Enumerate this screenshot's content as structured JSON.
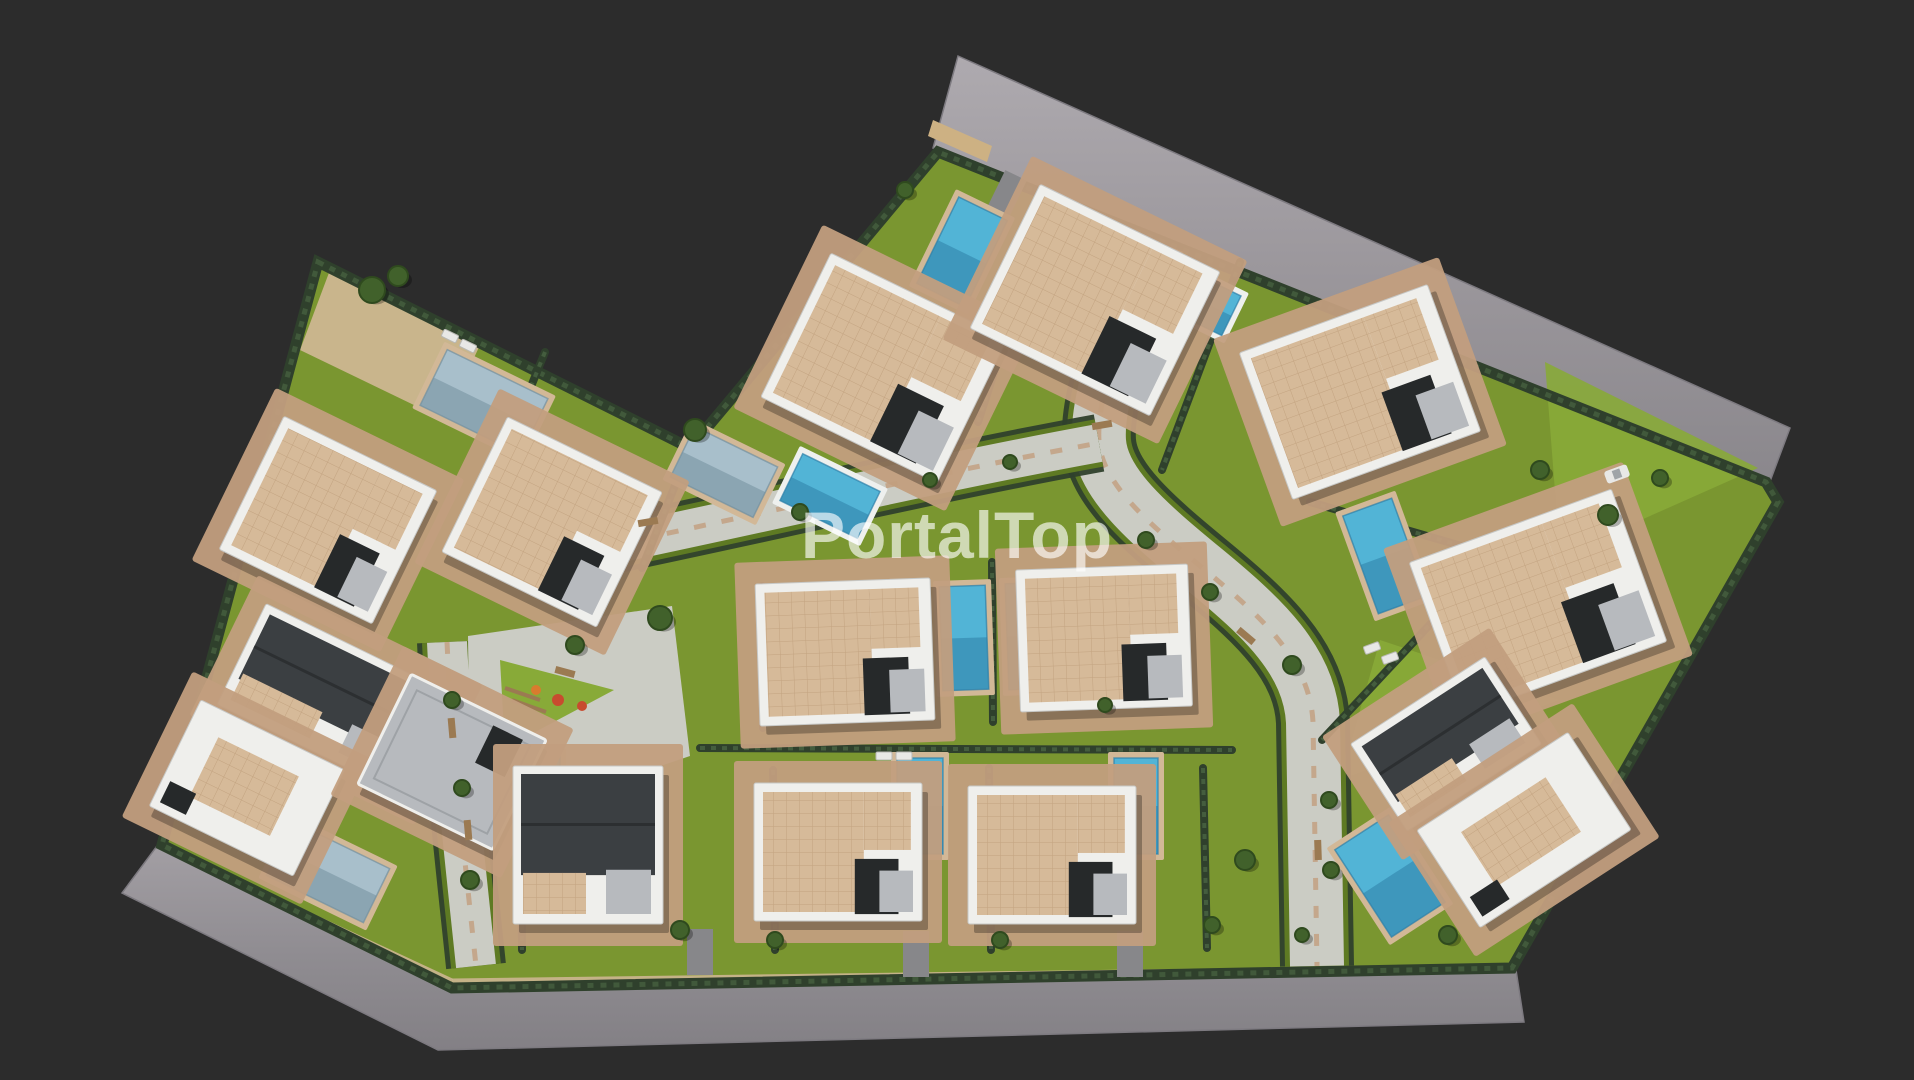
{
  "watermark": {
    "text": "PortalTop"
  },
  "colors": {
    "bg": "#2c2c2c",
    "road_top": "#9b979c",
    "road_top_light": "#aeaaaf",
    "road_bottom": "#8f8c91",
    "road_bottom_light": "#a39fa4",
    "road_edge": "#7d7a80",
    "sidewalk": "#cdb183",
    "site_lawn": "#7a9630",
    "lawn_bright": "#88aa38",
    "lawn_dark": "#5e7a23",
    "hedge": "#2f402c",
    "hedge_light": "#53714a",
    "paving": "#c29e7e",
    "paving_light": "#d2b897",
    "walkway": "#cbccc4",
    "pool_blue": "#52b4d6",
    "pool_blue_dark": "#2e7fa8",
    "pool_steel": "#a8bfcb",
    "pool_steel_dark": "#72909f",
    "pool_rim": "#eef0ee",
    "roof_tan": "#d6ba99",
    "roof_tan_line": "#b3906c",
    "roof_gray": "#b7babe",
    "roof_charcoal": "#3b3f42",
    "roof_charcoal_dark": "#2c2f31",
    "wall_white": "#efefec",
    "wall_shadow": "#c7c8c6",
    "dark_void": "#26292a",
    "tree": "#41612b",
    "tree_dark": "#2f4a1e",
    "bench": "#9b7a52",
    "play_red": "#c84b2f",
    "play_orange": "#d97b2e",
    "driveway": "#87878a",
    "car": "#e8e8e6",
    "shadow": "rgba(0,0,0,0.28)",
    "watermark": "rgba(255,255,255,0.64)"
  },
  "scene": {
    "canvas": {
      "w": 1914,
      "h": 1080
    },
    "site_outline": [
      [
        318,
        262
      ],
      [
        690,
        448
      ],
      [
        938,
        152
      ],
      [
        1766,
        482
      ],
      [
        1778,
        502
      ],
      [
        1512,
        968
      ],
      [
        452,
        988
      ],
      [
        162,
        845
      ]
    ],
    "roads": [
      {
        "name": "top-road",
        "tone": "top",
        "points": [
          [
            958,
            56
          ],
          [
            1790,
            428
          ],
          [
            1769,
            484
          ],
          [
            933,
            148
          ]
        ]
      },
      {
        "name": "bottom-road",
        "tone": "bottom",
        "points": [
          [
            160,
            842
          ],
          [
            452,
            984
          ],
          [
            1516,
            970
          ],
          [
            1524,
            1022
          ],
          [
            438,
            1050
          ],
          [
            122,
            893
          ]
        ]
      }
    ],
    "sidewalks": [
      {
        "points": [
          [
            933,
            120
          ],
          [
            992,
            146
          ],
          [
            987,
            162
          ],
          [
            928,
            136
          ]
        ]
      }
    ],
    "trim_lines": [
      {
        "from": [
          452,
          981
        ],
        "to": [
          1514,
          967
        ]
      },
      {
        "from": [
          166,
          848
        ],
        "to": [
          452,
          981
        ]
      }
    ],
    "lawn_patches": [
      {
        "points": [
          [
            1545,
            362
          ],
          [
            1758,
            468
          ],
          [
            1560,
            556
          ]
        ]
      },
      {
        "points": [
          [
            1380,
            640
          ],
          [
            1560,
            700
          ],
          [
            1340,
            780
          ]
        ]
      },
      {
        "points": [
          [
            330,
            270
          ],
          [
            480,
            345
          ],
          [
            445,
            420
          ],
          [
            300,
            350
          ]
        ],
        "tone": "paving"
      }
    ],
    "walkways": [
      {
        "name": "main-street",
        "path": "M1158,242 C1128,318 1096,392 1099,441 C1102,484 1148,523 1205,570 C1262,617 1310,661 1313,722 L1317,966",
        "width": 54
      },
      {
        "name": "cross-walk",
        "path": "M612,545 C770,512 940,472 1099,443",
        "width": 38
      },
      {
        "name": "left-walk",
        "path": "M447,642 C452,750 466,870 476,966",
        "width": 40
      }
    ],
    "plaza": {
      "points": [
        [
          468,
          636
        ],
        [
          672,
          606
        ],
        [
          690,
          756
        ],
        [
          560,
          800
        ],
        [
          470,
          800
        ]
      ]
    },
    "play_triangle": {
      "points": [
        [
          500,
          660
        ],
        [
          614,
          690
        ],
        [
          505,
          748
        ]
      ]
    },
    "play_items": [
      {
        "x": 558,
        "y": 700,
        "r": 6,
        "c": "play_red"
      },
      {
        "x": 582,
        "y": 706,
        "r": 5,
        "c": "play_red"
      },
      {
        "x": 536,
        "y": 690,
        "r": 5,
        "c": "play_orange"
      }
    ],
    "play_frames": [
      {
        "from": [
          505,
          688
        ],
        "to": [
          540,
          700
        ]
      },
      {
        "from": [
          512,
          700
        ],
        "to": [
          546,
          712
        ]
      }
    ],
    "hedges": [
      [
        [
          690,
          448
        ],
        [
          642,
          568
        ]
      ],
      [
        [
          545,
          352
        ],
        [
          463,
          554
        ]
      ],
      [
        [
          1048,
          208
        ],
        [
          978,
          422
        ]
      ],
      [
        [
          1240,
          262
        ],
        [
          1162,
          470
        ]
      ],
      [
        [
          1310,
          502
        ],
        [
          1496,
          556
        ]
      ],
      [
        [
          992,
          562
        ],
        [
          993,
          722
        ]
      ],
      [
        [
          762,
          586
        ],
        [
          763,
          728
        ]
      ],
      [
        [
          700,
          748
        ],
        [
          1232,
          750
        ]
      ],
      [
        [
          773,
          770
        ],
        [
          775,
          950
        ]
      ],
      [
        [
          989,
          768
        ],
        [
          991,
          950
        ]
      ],
      [
        [
          1203,
          768
        ],
        [
          1207,
          948
        ]
      ],
      [
        [
          1436,
          618
        ],
        [
          1322,
          740
        ]
      ],
      [
        [
          520,
          760
        ],
        [
          522,
          950
        ]
      ]
    ],
    "driveways": [
      {
        "x": 700,
        "y": 952,
        "w": 26,
        "h": 46,
        "rot": 0
      },
      {
        "x": 916,
        "y": 954,
        "w": 26,
        "h": 46,
        "rot": 0
      },
      {
        "x": 1130,
        "y": 954,
        "w": 26,
        "h": 46,
        "rot": 0
      },
      {
        "x": 1006,
        "y": 196,
        "w": 24,
        "h": 46,
        "rot": 26
      },
      {
        "x": 1580,
        "y": 560,
        "w": 24,
        "h": 44,
        "rot": -20
      }
    ],
    "pools": [
      {
        "x": 484,
        "y": 402,
        "w": 112,
        "h": 62,
        "rot": 26,
        "tone": "steel",
        "deck": false
      },
      {
        "x": 724,
        "y": 472,
        "w": 92,
        "h": 56,
        "rot": 26,
        "tone": "steel",
        "deck": false
      },
      {
        "x": 830,
        "y": 496,
        "w": 86,
        "h": 52,
        "rot": 26,
        "tone": "blue",
        "deck": true
      },
      {
        "x": 962,
        "y": 252,
        "w": 54,
        "h": 96,
        "rot": 26,
        "tone": "blue",
        "deck": false
      },
      {
        "x": 1199,
        "y": 300,
        "w": 72,
        "h": 44,
        "rot": 26,
        "tone": "blue",
        "deck": true
      },
      {
        "x": 1385,
        "y": 556,
        "w": 52,
        "h": 104,
        "rot": -20,
        "tone": "blue",
        "deck": false
      },
      {
        "x": 964,
        "y": 638,
        "w": 46,
        "h": 104,
        "rot": -2,
        "tone": "blue",
        "deck": false
      },
      {
        "x": 1030,
        "y": 636,
        "w": 46,
        "h": 106,
        "rot": -2,
        "tone": "blue",
        "deck": false
      },
      {
        "x": 920,
        "y": 806,
        "w": 46,
        "h": 96,
        "rot": 0,
        "tone": "blue",
        "deck": false
      },
      {
        "x": 1136,
        "y": 806,
        "w": 44,
        "h": 96,
        "rot": 0,
        "tone": "blue",
        "deck": false
      },
      {
        "x": 328,
        "y": 872,
        "w": 108,
        "h": 60,
        "rot": 26,
        "tone": "steel",
        "deck": false
      },
      {
        "x": 1390,
        "y": 876,
        "w": 64,
        "h": 104,
        "rot": -33,
        "tone": "blue",
        "deck": false
      },
      {
        "x": 538,
        "y": 788,
        "w": 44,
        "h": 66,
        "rot": 0,
        "tone": "blue",
        "deck": false
      }
    ],
    "villas": [
      {
        "x": 328,
        "y": 520,
        "w": 170,
        "h": 148,
        "rot": 26,
        "style": "tan"
      },
      {
        "x": 552,
        "y": 522,
        "w": 172,
        "h": 150,
        "rot": 26,
        "style": "tan"
      },
      {
        "x": 336,
        "y": 700,
        "w": 210,
        "h": 112,
        "rot": 26,
        "style": "charcoal"
      },
      {
        "x": 247,
        "y": 788,
        "w": 160,
        "h": 118,
        "rot": 26,
        "style": "white"
      },
      {
        "x": 452,
        "y": 762,
        "w": 150,
        "h": 122,
        "rot": 26,
        "style": "gray"
      },
      {
        "x": 884,
        "y": 368,
        "w": 196,
        "h": 160,
        "rot": 26,
        "style": "tan"
      },
      {
        "x": 1095,
        "y": 300,
        "w": 200,
        "h": 160,
        "rot": 26,
        "style": "tan"
      },
      {
        "x": 1360,
        "y": 392,
        "w": 200,
        "h": 156,
        "rot": -20,
        "style": "tan"
      },
      {
        "x": 1538,
        "y": 602,
        "w": 215,
        "h": 162,
        "rot": -20,
        "style": "tan"
      },
      {
        "x": 845,
        "y": 652,
        "w": 175,
        "h": 142,
        "rot": -2,
        "style": "tan"
      },
      {
        "x": 1104,
        "y": 638,
        "w": 172,
        "h": 142,
        "rot": -2,
        "style": "tan"
      },
      {
        "x": 588,
        "y": 845,
        "w": 150,
        "h": 158,
        "rot": 0,
        "style": "charcoal"
      },
      {
        "x": 838,
        "y": 852,
        "w": 168,
        "h": 138,
        "rot": 0,
        "style": "tan"
      },
      {
        "x": 1052,
        "y": 855,
        "w": 168,
        "h": 138,
        "rot": 0,
        "style": "tan"
      },
      {
        "x": 1446,
        "y": 744,
        "w": 160,
        "h": 104,
        "rot": -33,
        "style": "charcoal"
      },
      {
        "x": 1524,
        "y": 830,
        "w": 180,
        "h": 116,
        "rot": -33,
        "style": "white"
      }
    ],
    "trees": [
      {
        "x": 372,
        "y": 290,
        "r": 13
      },
      {
        "x": 398,
        "y": 276,
        "r": 10
      },
      {
        "x": 695,
        "y": 430,
        "r": 11
      },
      {
        "x": 905,
        "y": 190,
        "r": 8
      },
      {
        "x": 1608,
        "y": 515,
        "r": 10
      },
      {
        "x": 1660,
        "y": 478,
        "r": 8
      },
      {
        "x": 660,
        "y": 618,
        "r": 12
      },
      {
        "x": 575,
        "y": 645,
        "r": 9
      },
      {
        "x": 1146,
        "y": 540,
        "r": 8
      },
      {
        "x": 1210,
        "y": 592,
        "r": 8
      },
      {
        "x": 1292,
        "y": 665,
        "r": 9
      },
      {
        "x": 1329,
        "y": 800,
        "r": 8
      },
      {
        "x": 1331,
        "y": 870,
        "r": 8
      },
      {
        "x": 1302,
        "y": 935,
        "r": 7
      },
      {
        "x": 800,
        "y": 512,
        "r": 8
      },
      {
        "x": 930,
        "y": 480,
        "r": 7
      },
      {
        "x": 1010,
        "y": 462,
        "r": 7
      },
      {
        "x": 452,
        "y": 700,
        "r": 8
      },
      {
        "x": 462,
        "y": 788,
        "r": 8
      },
      {
        "x": 470,
        "y": 880,
        "r": 9
      },
      {
        "x": 680,
        "y": 930,
        "r": 9
      },
      {
        "x": 775,
        "y": 940,
        "r": 8
      },
      {
        "x": 1000,
        "y": 940,
        "r": 8
      },
      {
        "x": 1212,
        "y": 925,
        "r": 8
      },
      {
        "x": 1245,
        "y": 860,
        "r": 10
      },
      {
        "x": 1448,
        "y": 935,
        "r": 9
      },
      {
        "x": 1105,
        "y": 705,
        "r": 7
      },
      {
        "x": 1540,
        "y": 470,
        "r": 9
      }
    ],
    "benches": [
      {
        "x": 648,
        "y": 522,
        "rot": -10
      },
      {
        "x": 565,
        "y": 672,
        "rot": 15
      },
      {
        "x": 452,
        "y": 728,
        "rot": 85
      },
      {
        "x": 468,
        "y": 830,
        "rot": 85
      },
      {
        "x": 1246,
        "y": 636,
        "rot": 40
      },
      {
        "x": 1318,
        "y": 850,
        "rot": 88
      },
      {
        "x": 1102,
        "y": 425,
        "rot": -10
      }
    ],
    "loungers": [
      {
        "x": 450,
        "y": 336,
        "rot": 26
      },
      {
        "x": 468,
        "y": 346,
        "rot": 26
      },
      {
        "x": 1372,
        "y": 648,
        "rot": -20
      },
      {
        "x": 1390,
        "y": 658,
        "rot": -20
      },
      {
        "x": 884,
        "y": 756,
        "rot": 0
      },
      {
        "x": 904,
        "y": 756,
        "rot": 0
      }
    ],
    "car": {
      "x": 1617,
      "y": 474,
      "w": 24,
      "h": 13,
      "rot": -20
    }
  }
}
